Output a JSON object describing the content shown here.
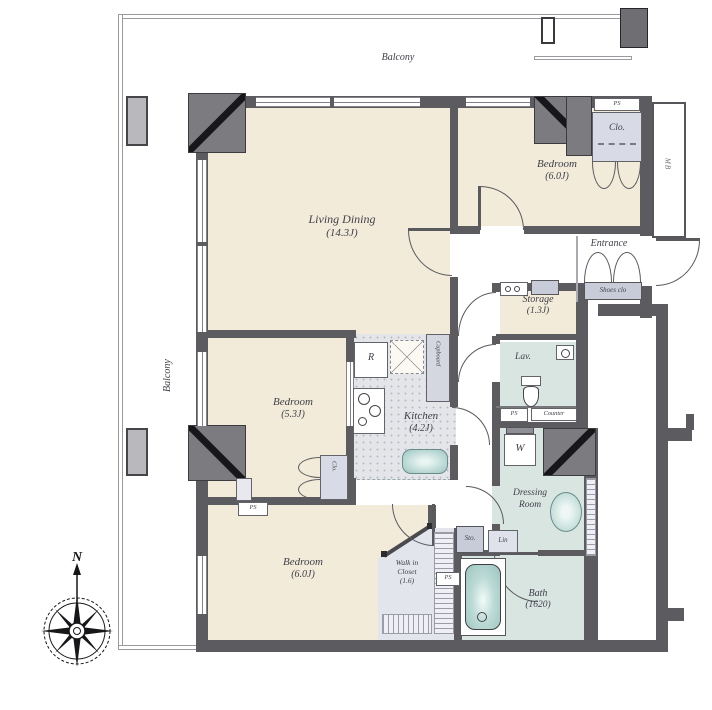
{
  "compass": {
    "north": "N"
  },
  "balconies": {
    "top": "Balcony",
    "left": "Balcony"
  },
  "rooms": {
    "living_dining": {
      "name": "Living Dining",
      "size": "(14.3J)"
    },
    "bedroom_top_right": {
      "name": "Bedroom",
      "size": "(6.0J)"
    },
    "bedroom_middle": {
      "name": "Bedroom",
      "size": "(5.3J)"
    },
    "bedroom_bottom": {
      "name": "Bedroom",
      "size": "(6.0J)"
    },
    "kitchen": {
      "name": "Kitchen",
      "size": "(4.2J)"
    },
    "storage": {
      "name": "Storage",
      "size": "(1.3J)"
    },
    "walk_in_closet": {
      "line1": "Walk in",
      "line2": "Closet",
      "size": "(1.6)"
    },
    "bath": {
      "name": "Bath",
      "size": "(1620)"
    },
    "lavatory": {
      "name": "Lav."
    },
    "dressing_room": {
      "line1": "Dressing",
      "line2": "Room"
    },
    "entrance": {
      "name": "Entrance"
    }
  },
  "fixtures": {
    "shoes_closet": "Shoes clo",
    "closet_abbr": "Clo.",
    "meter_box": "MB",
    "pipe_shaft": "PS",
    "counter": "Counter",
    "washer": "W",
    "refrigerator": "R",
    "cupboard": "Cupboard",
    "small_storage": "Sto.",
    "linen": "Lin"
  },
  "colors": {
    "room_beige": "#f2ebd9",
    "wet_blue": "#d9e5e1",
    "closet_gray": "#d8dbe5",
    "wall_gray": "#5b5b60",
    "fixture_teal": "#a9cdc9"
  }
}
